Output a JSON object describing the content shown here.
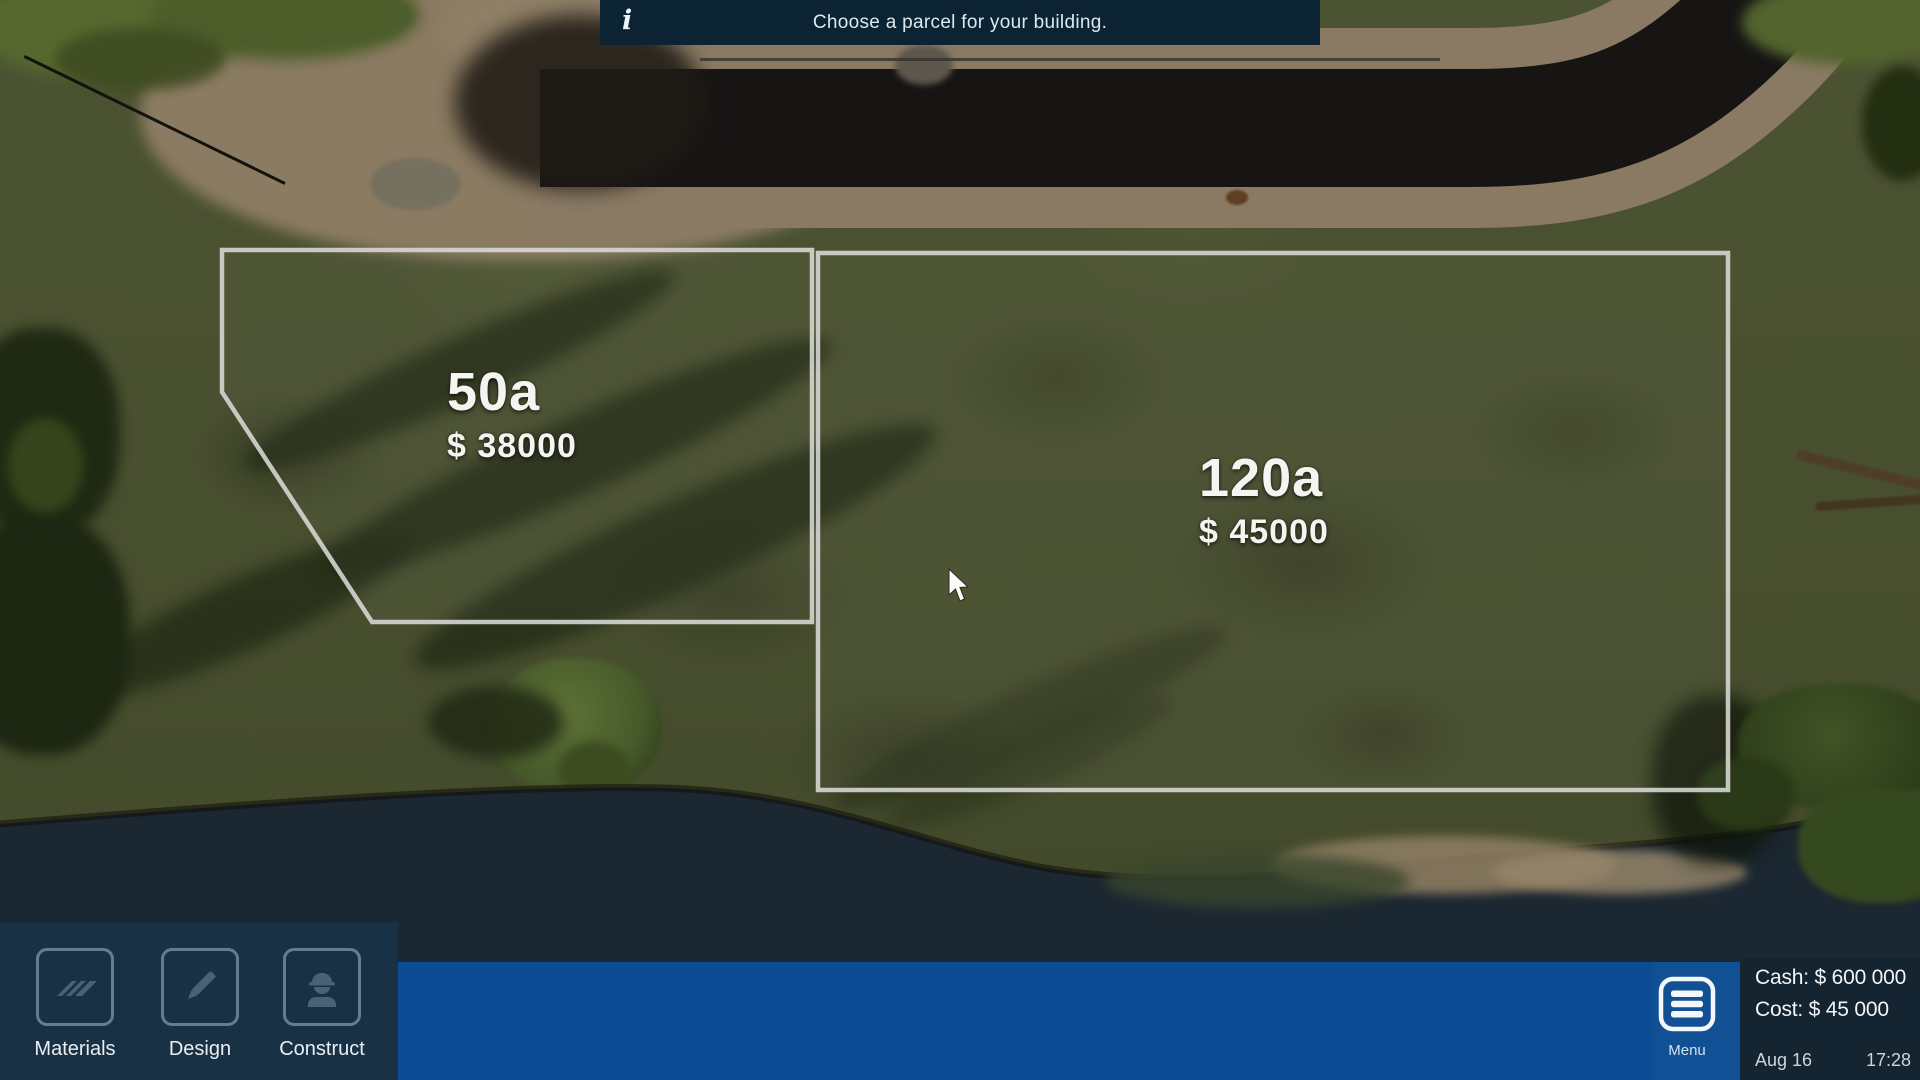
{
  "hud": {
    "banner": {
      "icon": "info-icon",
      "icon_glyph": "i",
      "message": "Choose a parcel for your building."
    },
    "toolbar": {
      "buttons": [
        {
          "label": "Materials",
          "icon": "materials-roof-icon"
        },
        {
          "label": "Design",
          "icon": "design-pencil-icon"
        },
        {
          "label": "Construct",
          "icon": "construct-worker-icon"
        }
      ]
    },
    "menu": {
      "label": "Menu",
      "icon": "menu-hamburger-icon"
    },
    "status": {
      "cash": "Cash: $ 600 000",
      "cost": "Cost: $ 45 000",
      "date": "Aug 16",
      "time": "17:28"
    }
  },
  "parcels": [
    {
      "area": "50a",
      "price": "$ 38000"
    },
    {
      "area": "120a",
      "price": "$ 45000"
    }
  ],
  "colors": {
    "accent_blue": "#0d4b95",
    "panel_navy": "#183144",
    "banner_navy": "#0c2334",
    "info_panel_navy": "#152431",
    "parcel_outline": "#d6d6d2"
  }
}
